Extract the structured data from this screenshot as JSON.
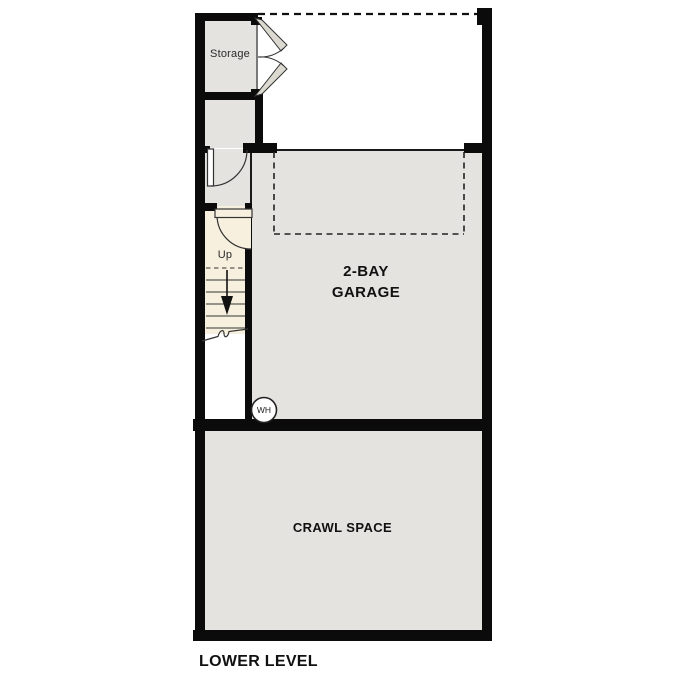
{
  "plan_title": "LOWER LEVEL",
  "rooms": {
    "storage": {
      "label": "Storage"
    },
    "garage": {
      "label_line1": "2-BAY",
      "label_line2": "GARAGE"
    },
    "crawl_space": {
      "label": "CRAWL SPACE"
    }
  },
  "stairs": {
    "direction_label": "Up"
  },
  "fixtures": {
    "water_heater": {
      "label": "WH"
    }
  },
  "colors": {
    "room_fill": "#e4e3e0",
    "stair_fill": "#f7f0de",
    "wall": "#0b0b0b",
    "line": "#1a1a1a",
    "background": "#ffffff"
  }
}
